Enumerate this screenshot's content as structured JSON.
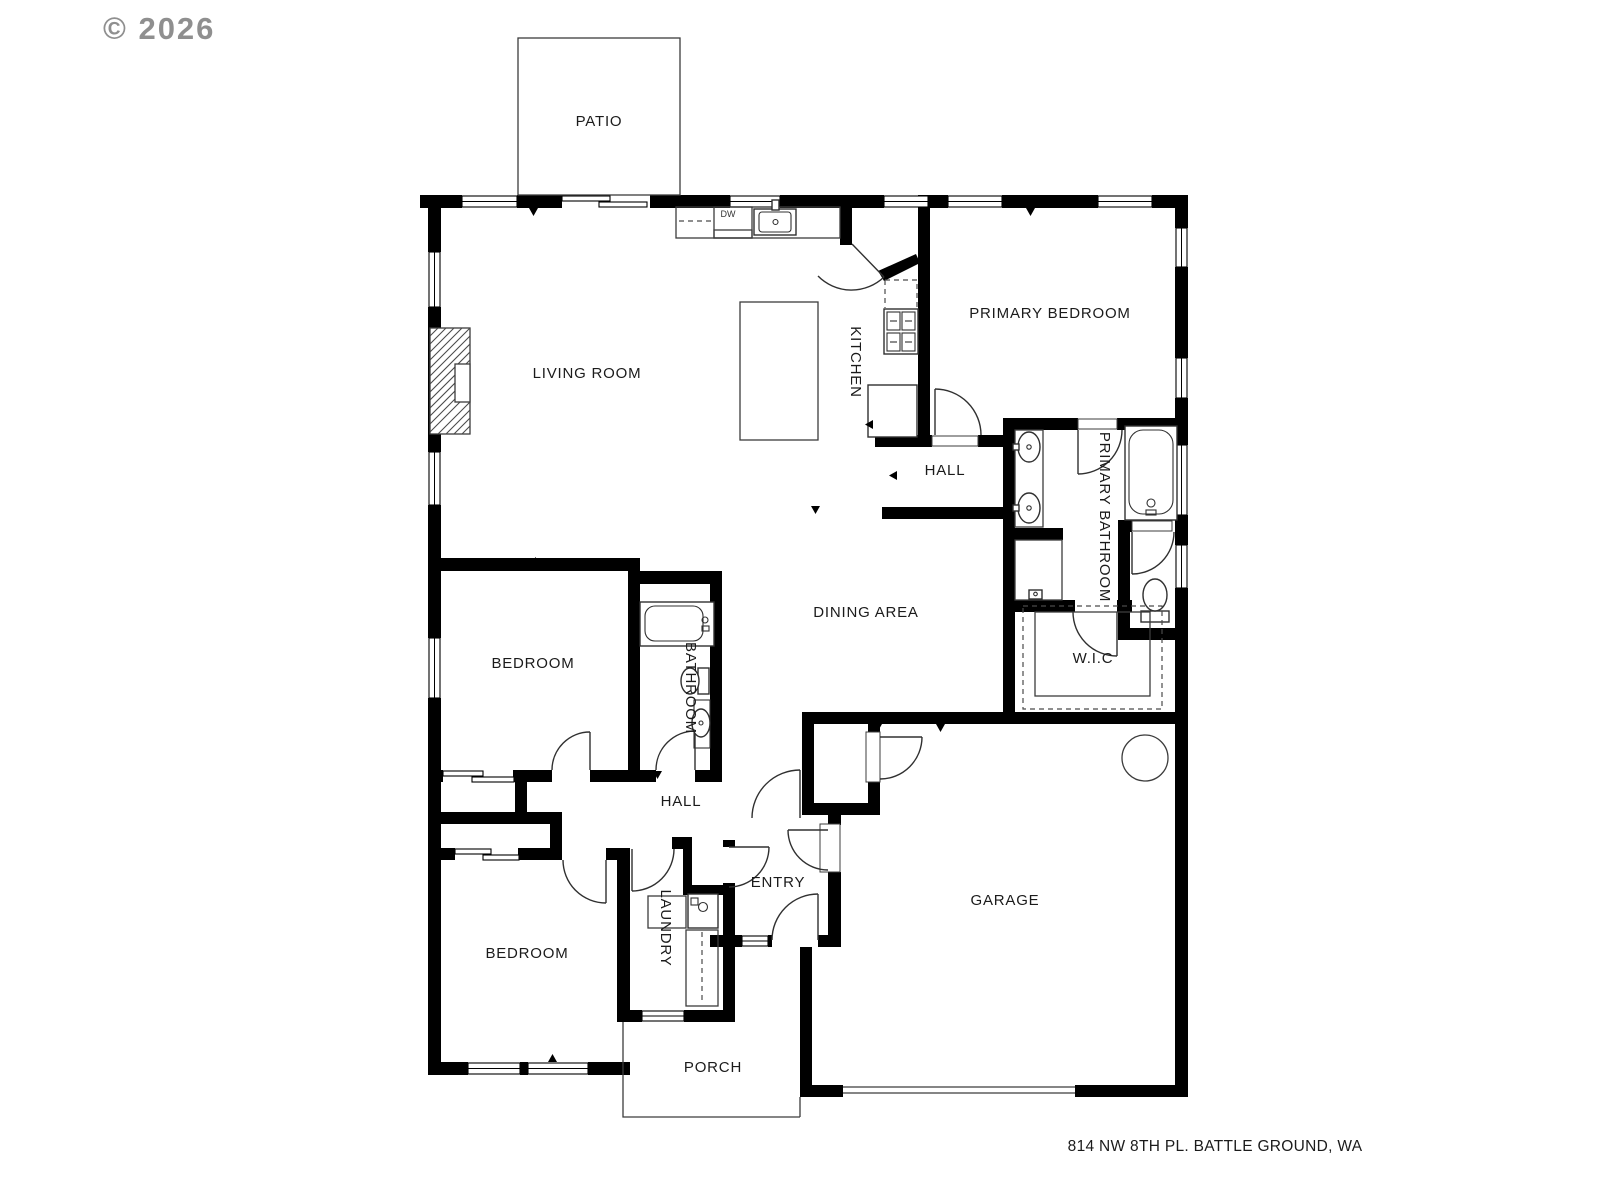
{
  "watermark": {
    "text": "© 2026"
  },
  "footer": {
    "address": "814 NW 8TH PL. BATTLE GROUND, WA"
  },
  "colors": {
    "background": "#ffffff",
    "wall": "#000000",
    "label": "#1b1b1b",
    "watermark": "#8f8f8f"
  },
  "rooms": {
    "patio": "PATIO",
    "living_room": "LIVING ROOM",
    "kitchen": "KITCHEN",
    "primary_bedroom": "PRIMARY BEDROOM",
    "hall_upper": "HALL",
    "primary_bathroom": "PRIMARY BATHROOM",
    "dining_area": "DINING AREA",
    "bedroom_middle": "BEDROOM",
    "bathroom": "BATHROOM",
    "wic": "W.I.C",
    "hall_lower": "HALL",
    "entry": "ENTRY",
    "laundry": "LAUNDRY",
    "bedroom_lower": "BEDROOM",
    "garage": "GARAGE",
    "porch": "PORCH"
  },
  "appliances": {
    "dishwasher": "DW"
  }
}
